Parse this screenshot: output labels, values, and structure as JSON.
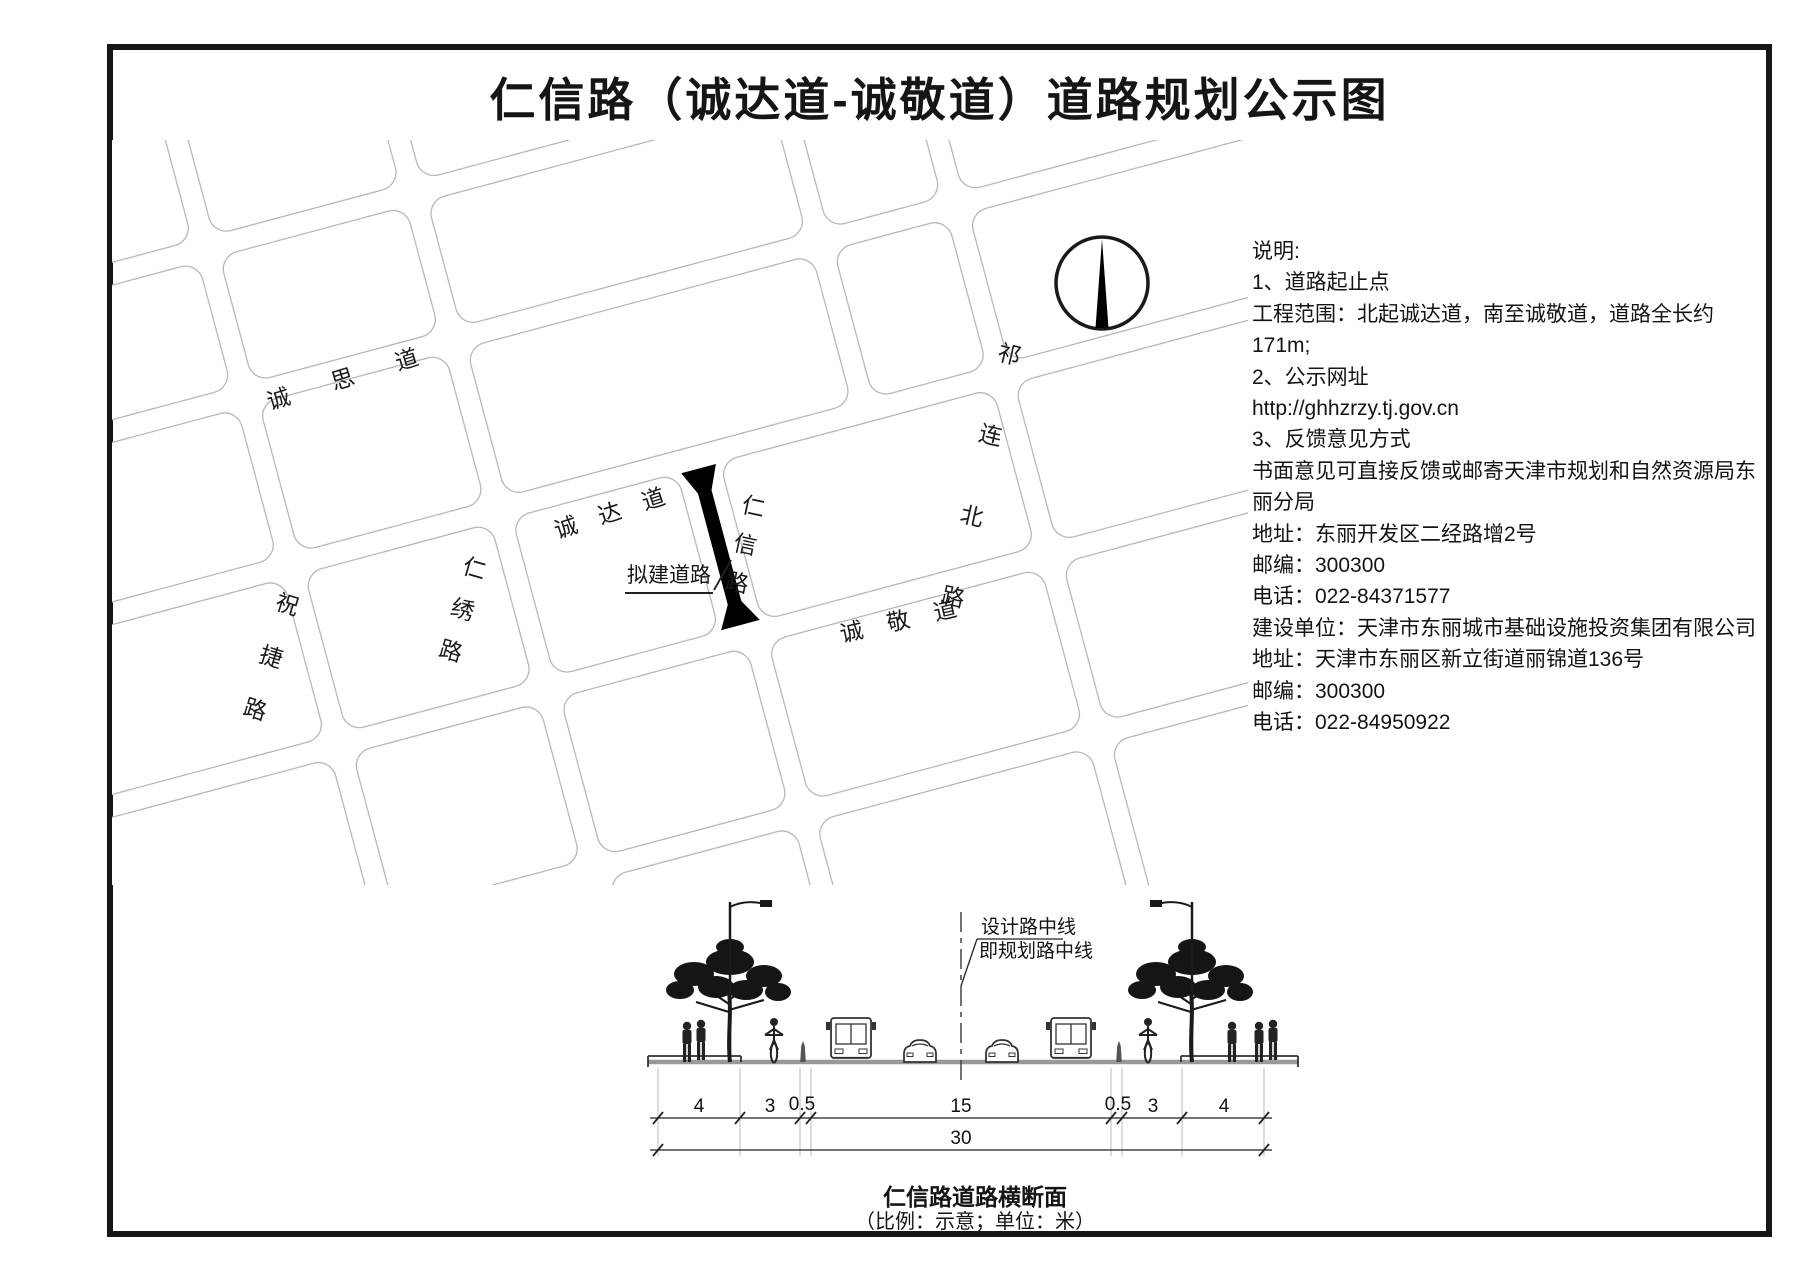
{
  "title": "仁信路（诚达道-诚敬道）道路规划公示图",
  "map": {
    "roads": {
      "chengsi": "诚思道",
      "chengda": "诚达道",
      "chengjing": "诚敬道",
      "zhujie": "祝捷路",
      "renxiu": "仁绣路",
      "renxin": "仁信路",
      "qilianbei": "祁连北路"
    },
    "proposed_road_label": "拟建道路",
    "north_arrow_icon": "north-arrow"
  },
  "notes": {
    "lines": [
      "说明:",
      "1、道路起止点",
      "工程范围：北起诚达道，南至诚敬道，道路全长约171m;",
      "2、公示网址",
      "http://ghhzrzy.tj.gov.cn",
      "3、反馈意见方式",
      "书面意见可直接反馈或邮寄天津市规划和自然资源局东",
      "丽分局",
      "地址：东丽开发区二经路增2号",
      "邮编：300300",
      "电话：022-84371577",
      "建设单位：天津市东丽城市基础设施投资集团有限公司",
      "地址：天津市东丽区新立街道丽锦道136号",
      "邮编：300300",
      "电话：022-84950922"
    ]
  },
  "cross_section": {
    "centerline_label_line1": "设计路中线",
    "centerline_label_line2": "即规划路中线",
    "dimensions": {
      "segments": [
        "4",
        "3",
        "0.5",
        "15",
        "0.5",
        "3",
        "4"
      ],
      "total": "30"
    },
    "caption": "仁信路道路横断面",
    "caption_note": "（比例：示意；单位：米）"
  }
}
